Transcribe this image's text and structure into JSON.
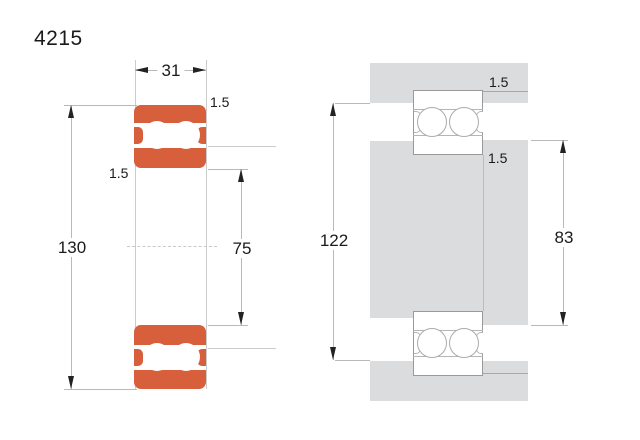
{
  "title": "4215",
  "section_view": {
    "width": "31",
    "outer_diameter": "130",
    "bore": "75",
    "chamfer_top": "1.5",
    "chamfer_bottom": "1.5"
  },
  "mounting_view": {
    "housing_abutment": "122",
    "shaft_abutment": "83",
    "fillet_top": "1.5",
    "fillet_bottom": "1.5"
  },
  "colors": {
    "bearing_orange": "#D75F3C",
    "steel_gray": "#DBDCDD",
    "dimension_line": "#b9b9b9",
    "arrow_black": "#222222"
  }
}
